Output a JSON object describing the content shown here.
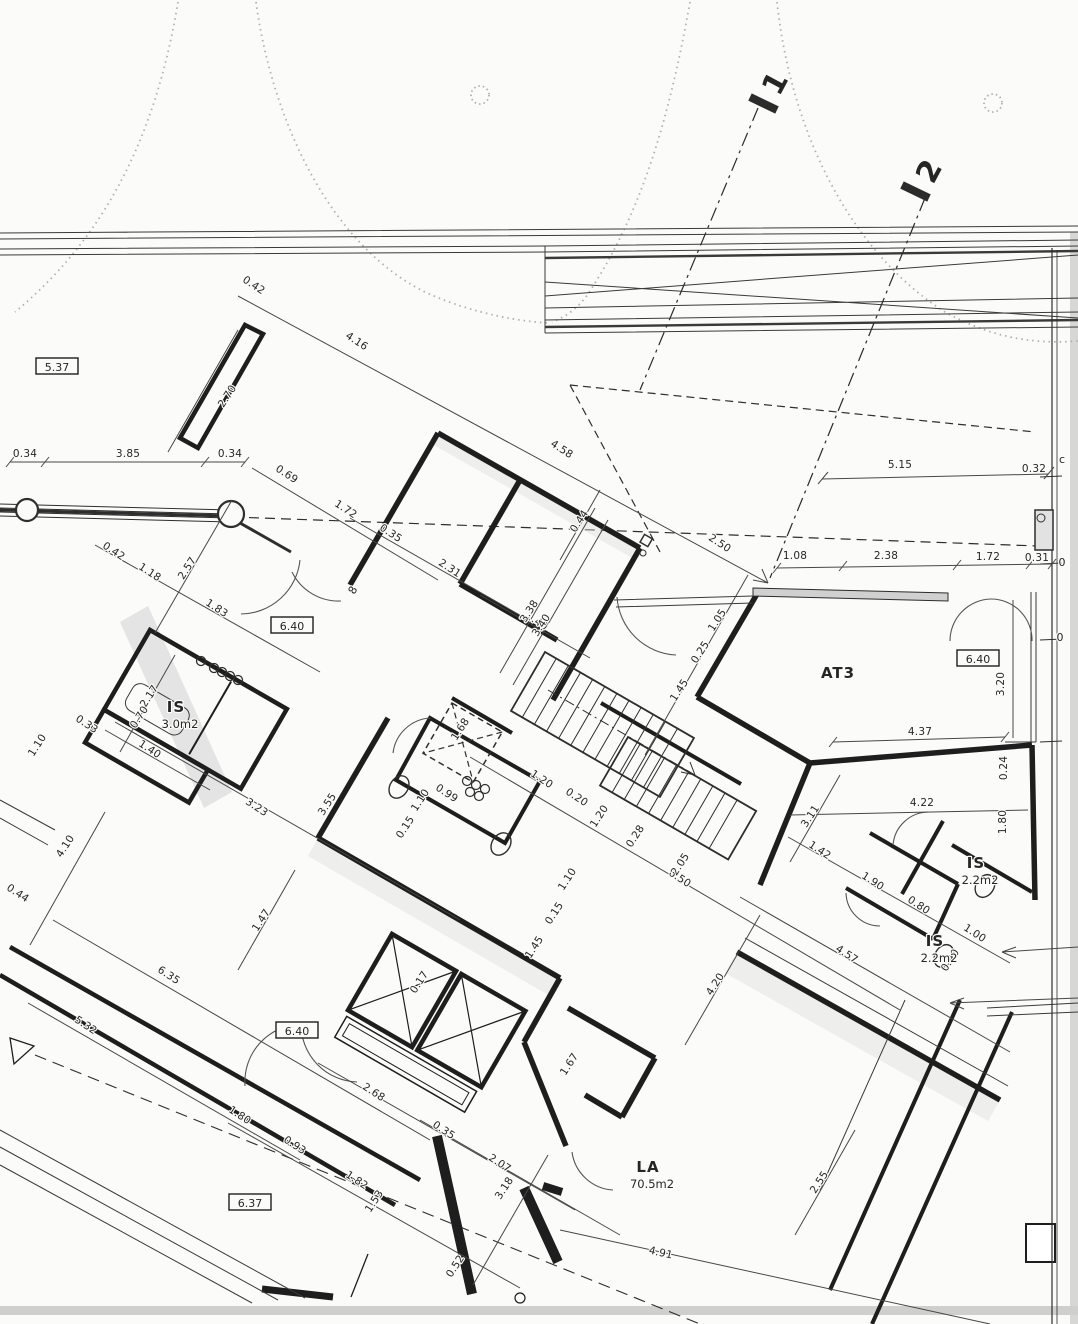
{
  "drawing": {
    "kind": "scanned architectural floor plan",
    "ink_color": "#262626",
    "wall_color": "#1e1e1e",
    "shade_color": "#dcdcdc"
  },
  "rooms": [
    {
      "name": "IS",
      "area": "3.0m2",
      "x": 176,
      "y": 712
    },
    {
      "name": "AT3",
      "area": "",
      "x": 838,
      "y": 678
    },
    {
      "name": "IS",
      "area": "2.2m2",
      "x": 976,
      "y": 868
    },
    {
      "name": "IS",
      "area": "2.2m2",
      "x": 935,
      "y": 946
    },
    {
      "name": "LA",
      "area": "70.5m2",
      "x": 648,
      "y": 1172
    }
  ],
  "level_markers": [
    {
      "value": "5.37",
      "x": 57,
      "y": 370
    },
    {
      "value": "6.40",
      "x": 292,
      "y": 629
    },
    {
      "value": "6.40",
      "x": 978,
      "y": 662
    },
    {
      "value": "6.40",
      "x": 297,
      "y": 1034
    },
    {
      "value": "6.37",
      "x": 250,
      "y": 1206
    }
  ],
  "section_markers": [
    {
      "label": "1",
      "x": 784,
      "y": 88,
      "rotation": -62
    },
    {
      "label": "2",
      "x": 938,
      "y": 176,
      "rotation": -62
    }
  ],
  "marks": [
    {
      "t": "8",
      "x": 356,
      "y": 592,
      "r": -60
    },
    {
      "t": "c",
      "x": 1062,
      "y": 463,
      "r": 0
    },
    {
      "t": "0",
      "x": 1062,
      "y": 566,
      "r": 0
    },
    {
      "t": "0",
      "x": 1060,
      "y": 641,
      "r": 0
    }
  ],
  "dimensions": [
    {
      "t": "0.42",
      "x": 252,
      "y": 288,
      "r": 33
    },
    {
      "t": "4.16",
      "x": 355,
      "y": 344,
      "r": 33
    },
    {
      "t": "2.70",
      "x": 230,
      "y": 398,
      "r": -57
    },
    {
      "t": "0.34",
      "x": 25,
      "y": 457,
      "r": 0
    },
    {
      "t": "3.85",
      "x": 128,
      "y": 457,
      "r": 0
    },
    {
      "t": "0.34",
      "x": 230,
      "y": 457,
      "r": 0
    },
    {
      "t": "0.69",
      "x": 285,
      "y": 477,
      "r": 33
    },
    {
      "t": "1.72",
      "x": 344,
      "y": 512,
      "r": 33
    },
    {
      "t": "4.58",
      "x": 560,
      "y": 452,
      "r": 33
    },
    {
      "t": "0.35",
      "x": 389,
      "y": 536,
      "r": 33
    },
    {
      "t": "2.31",
      "x": 448,
      "y": 571,
      "r": 33
    },
    {
      "t": "0.44",
      "x": 582,
      "y": 523,
      "r": -57
    },
    {
      "t": "2.50",
      "x": 718,
      "y": 546,
      "r": 33
    },
    {
      "t": "5.15",
      "x": 900,
      "y": 468,
      "r": 0
    },
    {
      "t": "0.32",
      "x": 1034,
      "y": 472,
      "r": 0
    },
    {
      "t": "1.08",
      "x": 795,
      "y": 559,
      "r": 0
    },
    {
      "t": "2.38",
      "x": 886,
      "y": 559,
      "r": 0
    },
    {
      "t": "1.72",
      "x": 988,
      "y": 560,
      "r": 0
    },
    {
      "t": "0.31",
      "x": 1037,
      "y": 561,
      "r": 0
    },
    {
      "t": "3.20",
      "x": 1004,
      "y": 684,
      "r": -90
    },
    {
      "t": "0.42",
      "x": 112,
      "y": 554,
      "r": 33
    },
    {
      "t": "1.18",
      "x": 148,
      "y": 575,
      "r": 33
    },
    {
      "t": "2.57",
      "x": 190,
      "y": 570,
      "r": -57
    },
    {
      "t": "1.83",
      "x": 215,
      "y": 611,
      "r": 33
    },
    {
      "t": "2.17",
      "x": 152,
      "y": 698,
      "r": -57
    },
    {
      "t": "0.70",
      "x": 142,
      "y": 719,
      "r": -57
    },
    {
      "t": "0.33",
      "x": 85,
      "y": 727,
      "r": 33
    },
    {
      "t": "1.10",
      "x": 40,
      "y": 747,
      "r": -57
    },
    {
      "t": "1.40",
      "x": 148,
      "y": 752,
      "r": 33
    },
    {
      "t": "0.44",
      "x": 16,
      "y": 896,
      "r": 33
    },
    {
      "t": "4.10",
      "x": 68,
      "y": 848,
      "r": -57
    },
    {
      "t": "3.23",
      "x": 255,
      "y": 810,
      "r": 33
    },
    {
      "t": "3.55",
      "x": 330,
      "y": 806,
      "r": -57
    },
    {
      "t": "1.47",
      "x": 264,
      "y": 922,
      "r": -57
    },
    {
      "t": "6.35",
      "x": 167,
      "y": 978,
      "r": 33
    },
    {
      "t": "5.32",
      "x": 84,
      "y": 1028,
      "r": 33
    },
    {
      "t": "2.68",
      "x": 372,
      "y": 1095,
      "r": 33
    },
    {
      "t": "1.80",
      "x": 238,
      "y": 1118,
      "r": 33
    },
    {
      "t": "0.93",
      "x": 293,
      "y": 1148,
      "r": 33
    },
    {
      "t": "1.82",
      "x": 355,
      "y": 1183,
      "r": 33
    },
    {
      "t": "1.53",
      "x": 377,
      "y": 1203,
      "r": -57
    },
    {
      "t": "0.35",
      "x": 442,
      "y": 1133,
      "r": 33
    },
    {
      "t": "2.07",
      "x": 498,
      "y": 1166,
      "r": 33
    },
    {
      "t": "3.18",
      "x": 507,
      "y": 1190,
      "r": -57
    },
    {
      "t": "0.52",
      "x": 458,
      "y": 1268,
      "r": -57
    },
    {
      "t": "4.91",
      "x": 660,
      "y": 1256,
      "r": 13
    },
    {
      "t": "1.40",
      "x": 535,
      "y": 624,
      "r": 33
    },
    {
      "t": "1.05",
      "x": 720,
      "y": 622,
      "r": -57
    },
    {
      "t": "0.25",
      "x": 703,
      "y": 654,
      "r": -57
    },
    {
      "t": "1.45",
      "x": 682,
      "y": 692,
      "r": -57
    },
    {
      "t": "3.38",
      "x": 532,
      "y": 613,
      "r": -57
    },
    {
      "t": "3.40",
      "x": 544,
      "y": 627,
      "r": -57
    },
    {
      "t": "1.68",
      "x": 463,
      "y": 731,
      "r": -57
    },
    {
      "t": "0.99",
      "x": 445,
      "y": 796,
      "r": 33
    },
    {
      "t": "1.10",
      "x": 423,
      "y": 802,
      "r": -57
    },
    {
      "t": "0.15",
      "x": 408,
      "y": 829,
      "r": -57
    },
    {
      "t": "1.20",
      "x": 540,
      "y": 782,
      "r": 33
    },
    {
      "t": "0.20",
      "x": 575,
      "y": 800,
      "r": 33
    },
    {
      "t": "1.20",
      "x": 602,
      "y": 818,
      "r": -57
    },
    {
      "t": "0.28",
      "x": 638,
      "y": 838,
      "r": -57
    },
    {
      "t": "6.50",
      "x": 678,
      "y": 881,
      "r": 33
    },
    {
      "t": "2.05",
      "x": 683,
      "y": 866,
      "r": -57
    },
    {
      "t": "1.10",
      "x": 570,
      "y": 881,
      "r": -57
    },
    {
      "t": "0.15",
      "x": 557,
      "y": 915,
      "r": -57
    },
    {
      "t": "1.45",
      "x": 537,
      "y": 949,
      "r": -57
    },
    {
      "t": "0.17",
      "x": 422,
      "y": 984,
      "r": -57
    },
    {
      "t": "1.67",
      "x": 572,
      "y": 1066,
      "r": -57
    },
    {
      "t": "4.37",
      "x": 920,
      "y": 735,
      "r": 0
    },
    {
      "t": "4.22",
      "x": 922,
      "y": 806,
      "r": 0
    },
    {
      "t": "3.11",
      "x": 813,
      "y": 818,
      "r": -57
    },
    {
      "t": "1.42",
      "x": 818,
      "y": 853,
      "r": 33
    },
    {
      "t": "1.90",
      "x": 871,
      "y": 884,
      "r": 33
    },
    {
      "t": "0.80",
      "x": 917,
      "y": 908,
      "r": 33
    },
    {
      "t": "1.00",
      "x": 973,
      "y": 936,
      "r": 33
    },
    {
      "t": "0.90",
      "x": 953,
      "y": 962,
      "r": -57
    },
    {
      "t": "1.80",
      "x": 1006,
      "y": 822,
      "r": -90
    },
    {
      "t": "0.24",
      "x": 1007,
      "y": 768,
      "r": -90
    },
    {
      "t": "4.57",
      "x": 845,
      "y": 957,
      "r": 33
    },
    {
      "t": "4.20",
      "x": 718,
      "y": 986,
      "r": -57
    },
    {
      "t": "2.55",
      "x": 822,
      "y": 1184,
      "r": -57
    }
  ]
}
